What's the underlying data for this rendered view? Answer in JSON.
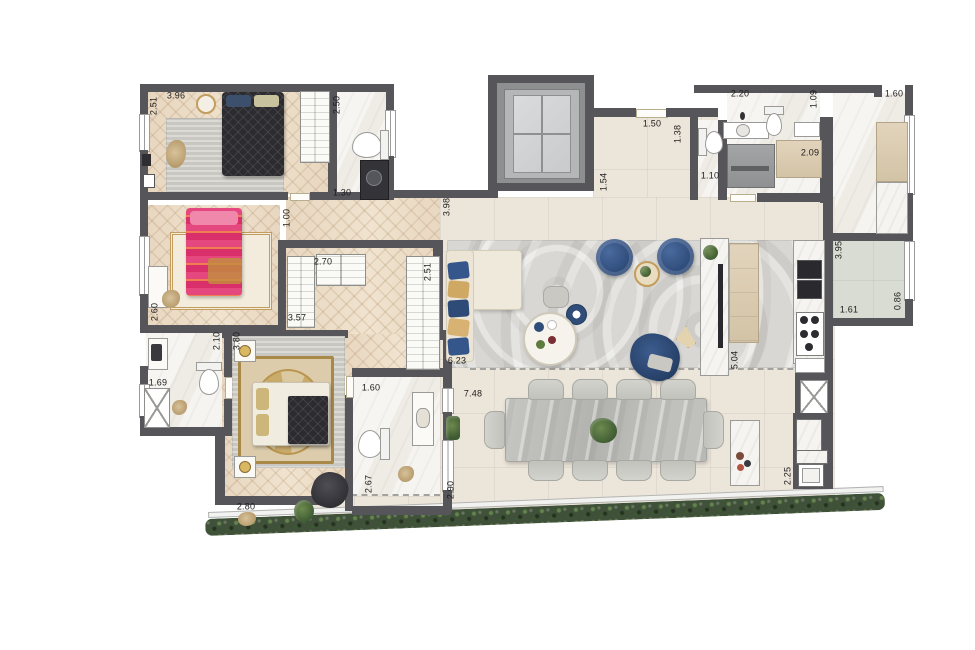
{
  "plan_title": "apartment-floor-plan",
  "colors": {
    "wall": "#55555a",
    "wood": "#e8d7c0",
    "marble": "#f5f3ef",
    "tile": "#ece5da",
    "terrace_side": "#d9dcd2",
    "rug_living": "#d8d7d3",
    "rug_gray": "#cfcdc7",
    "hedge": "#3f5138",
    "accent_blue": "#2f4d78",
    "bed_dark": "#2c2c30",
    "bed_pink": "#dc3a74",
    "gold": "#c29d5d",
    "stone": "#bcbcb8"
  },
  "dimensions": [
    {
      "id": "dim-bed1-width",
      "text": "3.96",
      "x": 176,
      "y": 96,
      "rot": false
    },
    {
      "id": "dim-bed1-depth",
      "text": "2.51",
      "x": 154,
      "y": 106,
      "rot": true
    },
    {
      "id": "dim-bath1-height",
      "text": "2.50",
      "x": 337,
      "y": 105,
      "rot": true
    },
    {
      "id": "dim-bath1-width",
      "text": "1.30",
      "x": 342,
      "y": 193,
      "rot": false
    },
    {
      "id": "dim-hall-width",
      "text": "1.00",
      "x": 287,
      "y": 218,
      "rot": true
    },
    {
      "id": "dim-closet-top",
      "text": "2.70",
      "x": 323,
      "y": 262,
      "rot": false
    },
    {
      "id": "dim-closet-right",
      "text": "2.51",
      "x": 428,
      "y": 272,
      "rot": true
    },
    {
      "id": "dim-closet-length",
      "text": "3.57",
      "x": 297,
      "y": 318,
      "rot": false
    },
    {
      "id": "dim-bed2-width",
      "text": "2.60",
      "x": 155,
      "y": 312,
      "rot": true
    },
    {
      "id": "dim-bath2-depth",
      "text": "2.10",
      "x": 217,
      "y": 341,
      "rot": true
    },
    {
      "id": "dim-master-depth",
      "text": "3.80",
      "x": 237,
      "y": 341,
      "rot": true
    },
    {
      "id": "dim-bath2-width",
      "text": "1.69",
      "x": 158,
      "y": 383,
      "rot": false
    },
    {
      "id": "dim-bath3-width",
      "text": "1.60",
      "x": 371,
      "y": 388,
      "rot": false
    },
    {
      "id": "dim-bath3-depth",
      "text": "2.67",
      "x": 369,
      "y": 484,
      "rot": true
    },
    {
      "id": "dim-master-width",
      "text": "2.80",
      "x": 246,
      "y": 507,
      "rot": false
    },
    {
      "id": "dim-master-terrace",
      "text": "2.90",
      "x": 451,
      "y": 490,
      "rot": true
    },
    {
      "id": "dim-living-width",
      "text": "6.23",
      "x": 457,
      "y": 361,
      "rot": false
    },
    {
      "id": "dim-terrace-width",
      "text": "7.48",
      "x": 473,
      "y": 394,
      "rot": false
    },
    {
      "id": "dim-living-depth",
      "text": "3.98",
      "x": 447,
      "y": 207,
      "rot": true
    },
    {
      "id": "dim-entry-width",
      "text": "1.50",
      "x": 652,
      "y": 124,
      "rot": false
    },
    {
      "id": "dim-entry-depth",
      "text": "1.54",
      "x": 604,
      "y": 182,
      "rot": true
    },
    {
      "id": "dim-wc-depth",
      "text": "1.38",
      "x": 678,
      "y": 134,
      "rot": true
    },
    {
      "id": "dim-wc-width",
      "text": "1.10",
      "x": 710,
      "y": 176,
      "rot": false
    },
    {
      "id": "dim-laundry-width",
      "text": "2.20",
      "x": 740,
      "y": 94,
      "rot": false
    },
    {
      "id": "dim-laundry-depth",
      "text": "1.09",
      "x": 814,
      "y": 99,
      "rot": true
    },
    {
      "id": "dim-pantry-width",
      "text": "1.60",
      "x": 894,
      "y": 94,
      "rot": false
    },
    {
      "id": "dim-laundry-inner",
      "text": "2.09",
      "x": 810,
      "y": 153,
      "rot": false
    },
    {
      "id": "dim-kitchen-depth",
      "text": "3.95",
      "x": 839,
      "y": 250,
      "rot": true
    },
    {
      "id": "dim-sideterrace-width",
      "text": "1.61",
      "x": 849,
      "y": 310,
      "rot": false
    },
    {
      "id": "dim-sideterrace-depth",
      "text": "0.86",
      "x": 898,
      "y": 301,
      "rot": true
    },
    {
      "id": "dim-kitchen-run",
      "text": "5.04",
      "x": 735,
      "y": 360,
      "rot": true
    },
    {
      "id": "dim-grill-depth",
      "text": "2.25",
      "x": 788,
      "y": 476,
      "rot": true
    }
  ]
}
